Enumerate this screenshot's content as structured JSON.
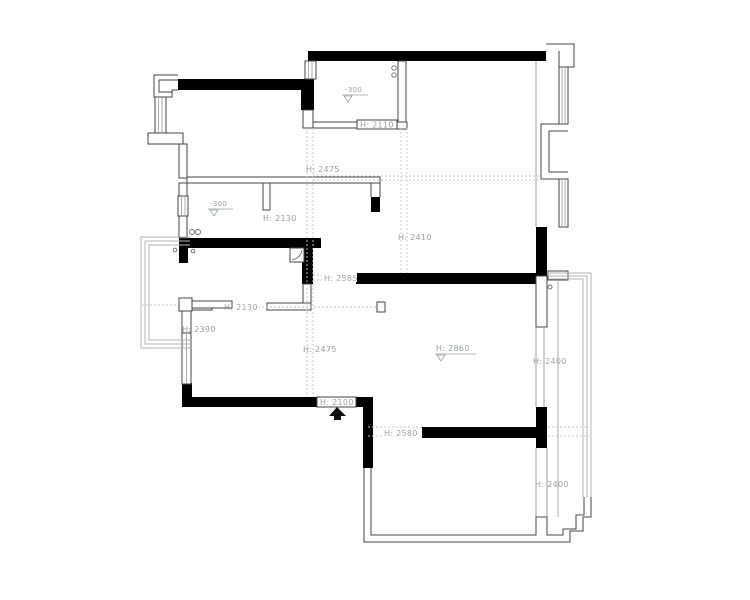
{
  "plan": {
    "title": "apartment-floor-plan",
    "labels": {
      "h2110": "H: 2110",
      "h2475_top": "H: 2475",
      "h2130_hall": "H: 2130",
      "h2410": "H: 2410",
      "h2585": "H: 2585",
      "h2130_balcony": "H: 2130",
      "h2390": "H: 2390",
      "h2475_living": "H: 2475",
      "h2860": "H: 2860",
      "h2400_upper": "H: 2400",
      "h2100": "H: 2100",
      "h2580": "H: 2580",
      "h2400_lower": "H: 2400",
      "level_bathroom": "-300",
      "level_storage": "-300"
    },
    "colors": {
      "wall": "#000000",
      "thin_wall": "#454545",
      "window": "#9a9a9a",
      "balcony_rail": "#b3b3b3",
      "reference_line": "#c9c9c9",
      "label_text": "#9aa3a8",
      "background": "#ffffff"
    }
  }
}
